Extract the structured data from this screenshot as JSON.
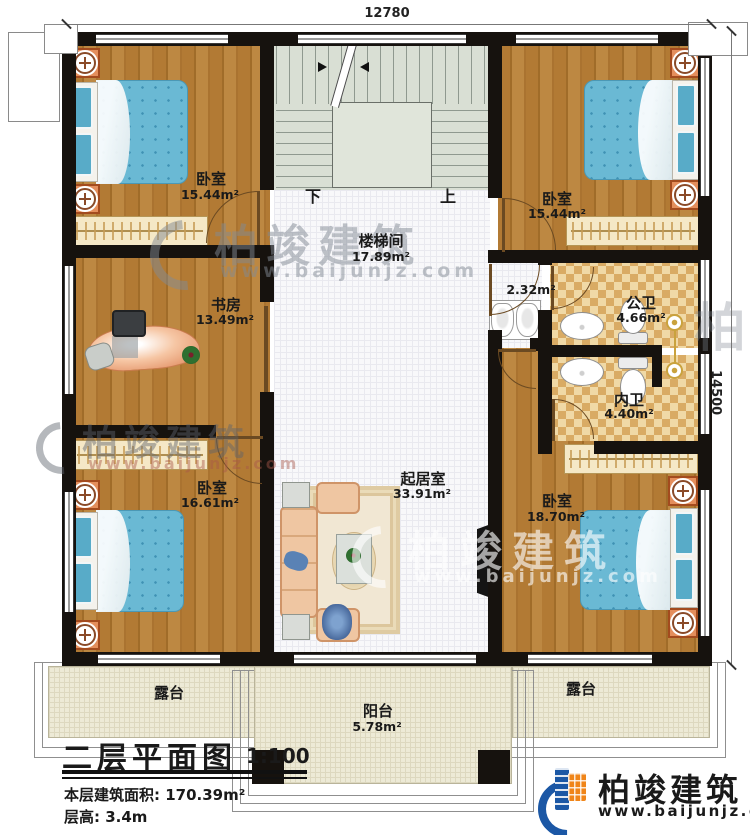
{
  "dimensions": {
    "top": "12780",
    "right": "14500"
  },
  "rooms": {
    "bedroom_tl": {
      "name": "卧室",
      "area": "15.44m²"
    },
    "bedroom_tr": {
      "name": "卧室",
      "area": "15.44m²"
    },
    "stairwell": {
      "name": "楼梯间",
      "area": "17.89m²"
    },
    "study": {
      "name": "书房",
      "area": "13.49m²"
    },
    "corridor": {
      "area": "2.32m²"
    },
    "public_bath": {
      "name": "公卫",
      "area": "4.66m²"
    },
    "ensuite_bath": {
      "name": "内卫",
      "area": "4.40m²"
    },
    "bedroom_bl": {
      "name": "卧室",
      "area": "16.61m²"
    },
    "living": {
      "name": "起居室",
      "area": "33.91m²"
    },
    "bedroom_br": {
      "name": "卧室",
      "area": "18.70m²"
    },
    "terrace_left": {
      "name": "露台"
    },
    "terrace_right": {
      "name": "露台"
    },
    "balcony": {
      "name": "阳台",
      "area": "5.78m²"
    }
  },
  "stairs": {
    "down_label": "下",
    "up_label": "上"
  },
  "title_block": {
    "title": "二层平面图",
    "scale": "1:100",
    "floor_area": "本层建筑面积: 170.39m²",
    "floor_height": "层高: 3.4m"
  },
  "brand": {
    "name": "柏竣建筑",
    "website": "www.baijunjz.com"
  },
  "colors": {
    "wall": "#16120e",
    "wood_floor": "#b27a34",
    "stair_floor": "#d9dfd4",
    "bath_tile": "#d9ab64",
    "bed_blue": "#6ab9d4",
    "logo_blue": "#1b57a5",
    "logo_orange": "#f08519"
  }
}
